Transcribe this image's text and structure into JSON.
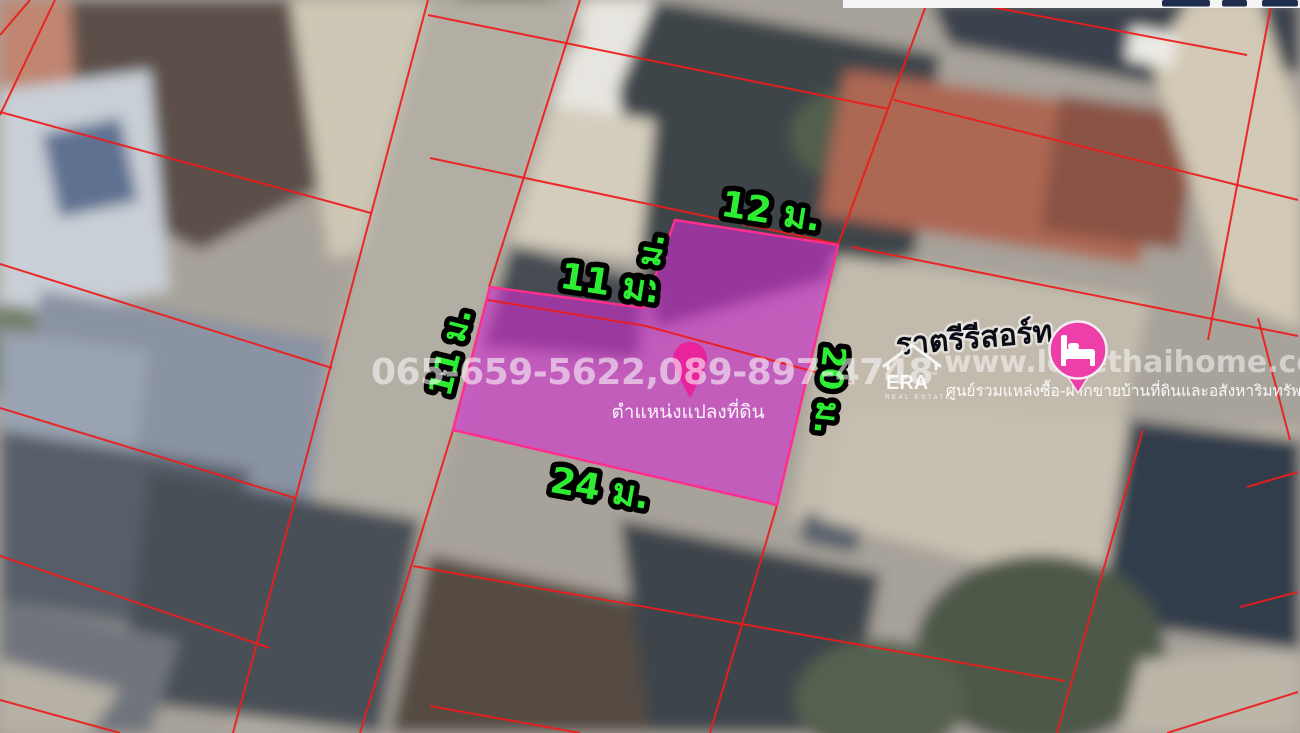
{
  "map": {
    "dimension_labels": [
      {
        "side": "top",
        "text": "12 ม."
      },
      {
        "side": "notch-vertical",
        "text": "8 ม."
      },
      {
        "side": "notch-horizontal",
        "text": "11 ม."
      },
      {
        "side": "left",
        "text": "11 ม."
      },
      {
        "side": "right",
        "text": "20 ม."
      },
      {
        "side": "bottom",
        "text": "24 ม."
      }
    ],
    "plot_location_label": "ตำแหน่งแปลงที่ดิน",
    "colors": {
      "dimension_label_green": "#2dee33",
      "plot_fill_magenta": "#d32fd3",
      "plot_outline_pink": "#ff2e8e",
      "parcel_line_red": "#ee1b1b",
      "location_pin_pink": "#e8239b",
      "brand_marker_pink": "#ee3fa8"
    }
  },
  "watermarks": {
    "phone_numbers": "065-659-5622,089-897-4748",
    "website": "www.lovethaihome.com",
    "tagline": "ศูนย์รวมแหล่งซื้อ-ฝากขายบ้านที่ดินและอสังหาริมทรัพย์",
    "brand_name": "ราตรีรีสอร์ท",
    "era_logo": {
      "title": "ERA",
      "trademark": "™",
      "subtitle": "REAL ESTATE"
    }
  }
}
